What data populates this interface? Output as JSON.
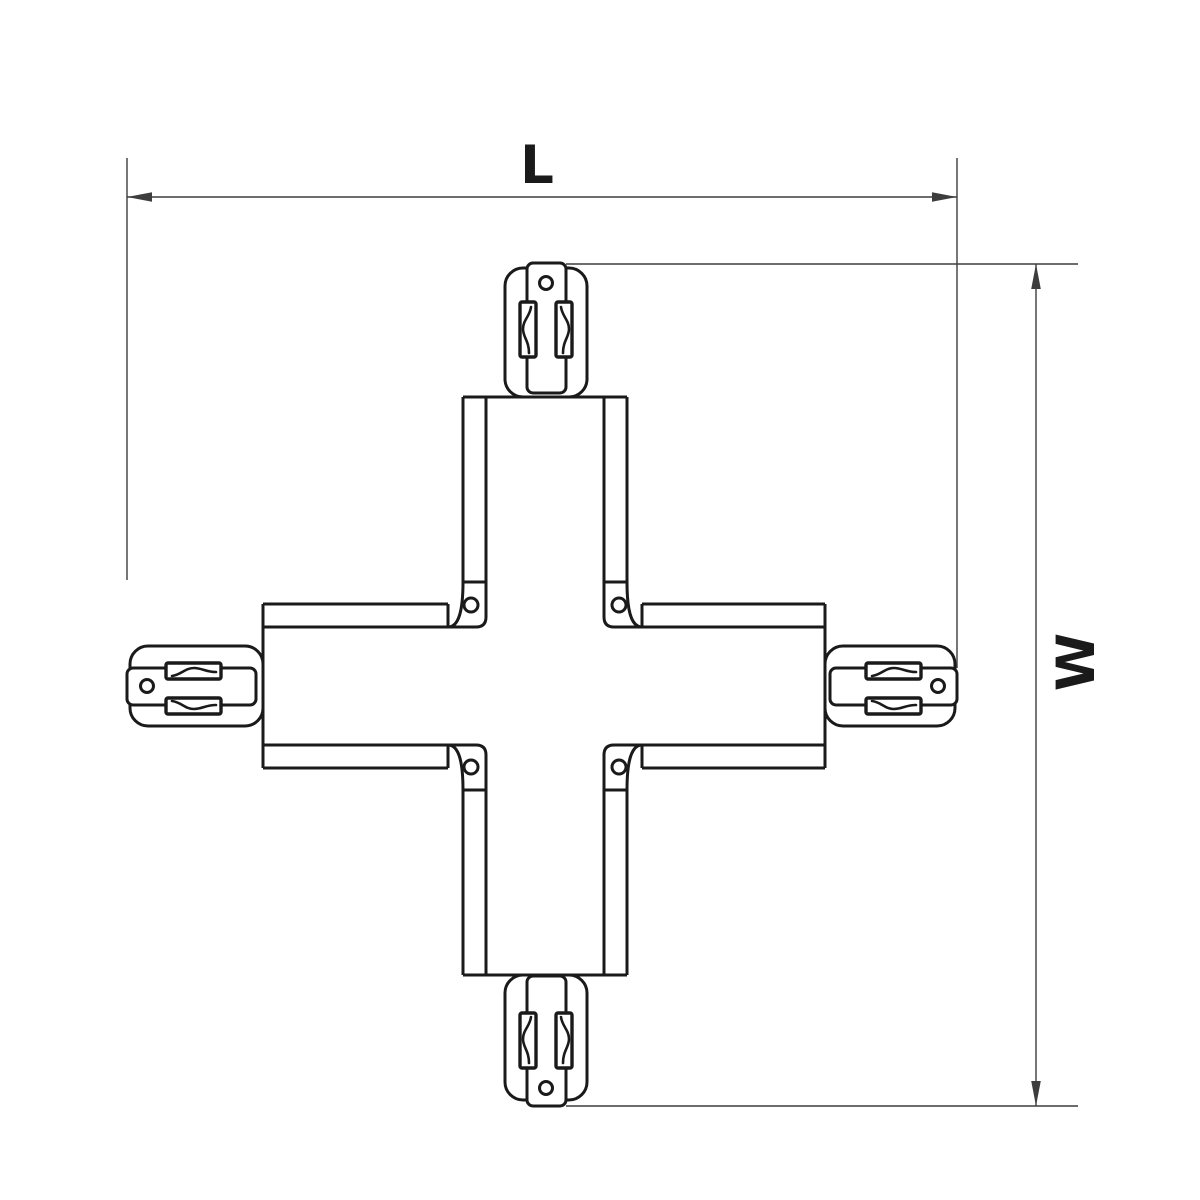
{
  "drawing": {
    "background": "#ffffff",
    "line_color": "#1a1a1a",
    "dimension_color": "#3d3d3d",
    "dimensions": {
      "length_label": "L",
      "width_label": "W"
    }
  }
}
